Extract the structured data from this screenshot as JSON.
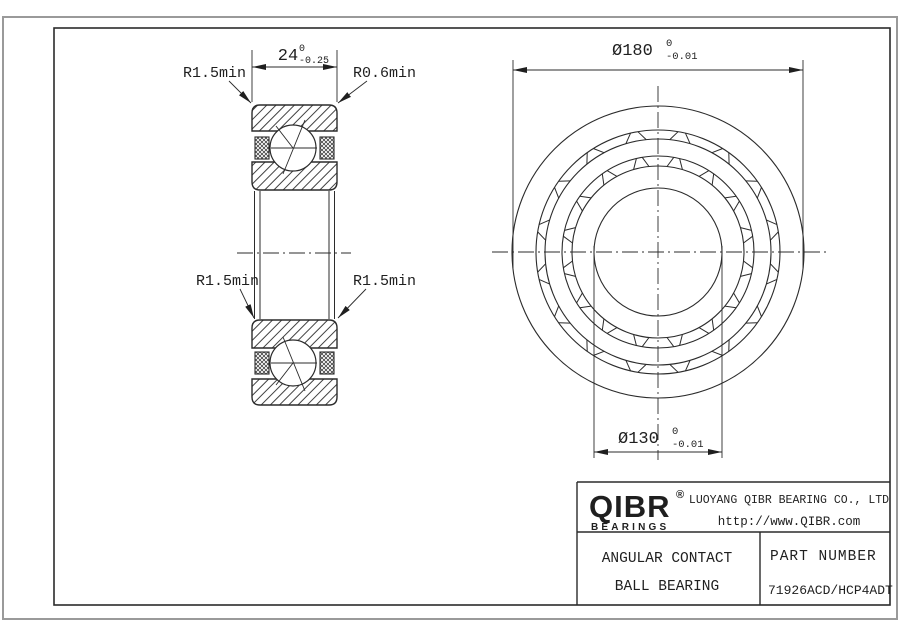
{
  "drawing": {
    "section_view": {
      "dim_width": {
        "value": "24",
        "tol_upper": "0",
        "tol_lower": "-0.25"
      },
      "label_top_left": "R1.5min",
      "label_top_right": "R0.6min",
      "label_mid_left": "R1.5min",
      "label_mid_right": "R1.5min"
    },
    "front_view": {
      "dim_outer": {
        "value": "Ø180",
        "tol_upper": "0",
        "tol_lower": "-0.01"
      },
      "dim_bore": {
        "value": "Ø130",
        "tol_upper": "0",
        "tol_lower": "-0.01"
      }
    }
  },
  "title_block": {
    "brand": "QIBR",
    "registered": "®",
    "brand_sub": "BEARINGS",
    "company": "LUOYANG QIBR BEARING CO., LTD",
    "website": "http://www.QIBR.com",
    "product_line1": "ANGULAR CONTACT",
    "product_line2": "BALL BEARING",
    "part_number_label": "PART NUMBER",
    "part_number": "71926ACD/HCP4ADT"
  },
  "colors": {
    "line": "#2b2b2b",
    "border": "#9a9a9a",
    "background": "#ffffff"
  }
}
